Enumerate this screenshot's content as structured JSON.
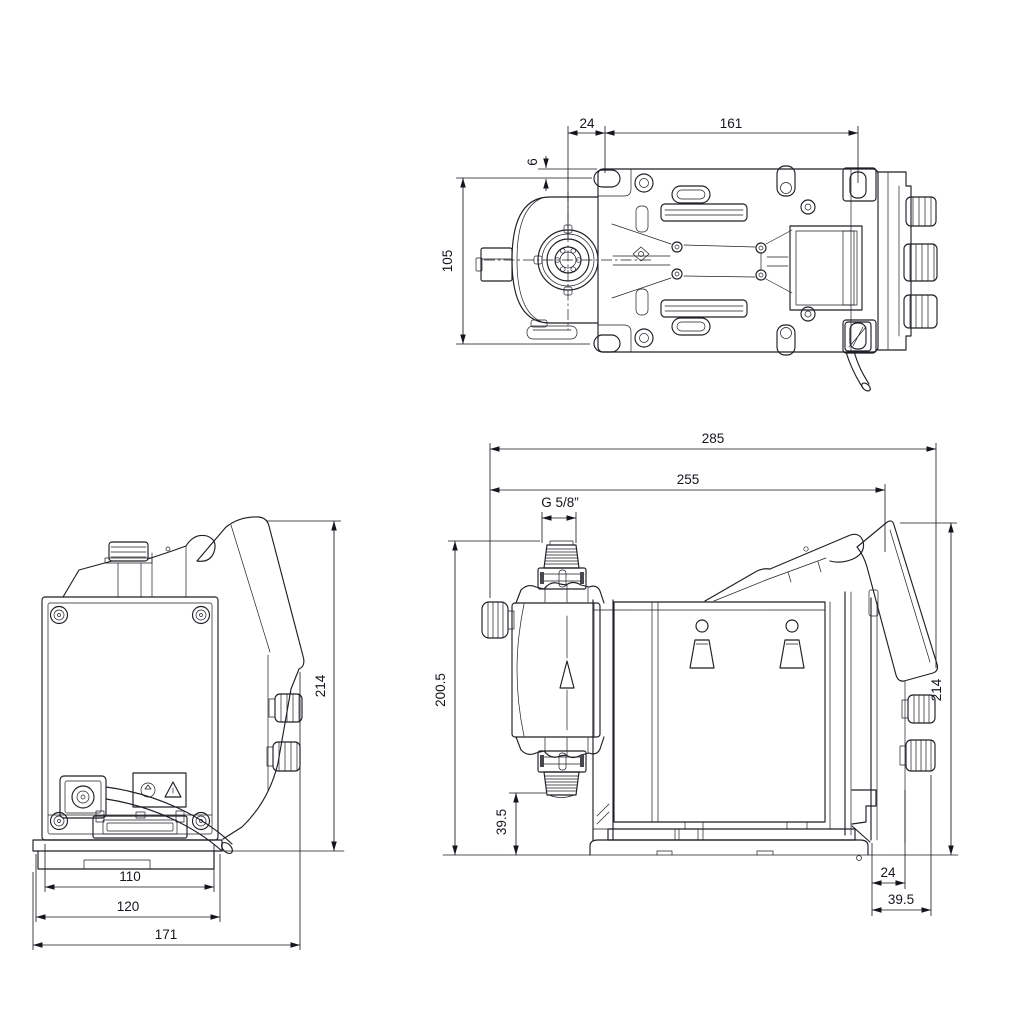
{
  "colors": {
    "background": "#ffffff",
    "line": "#1f1f26",
    "dim_text": "#15151d"
  },
  "views": {
    "top": {
      "title": "top-view",
      "dims": {
        "d24": "24",
        "d161": "161",
        "d6": "6",
        "d105": "105"
      }
    },
    "rear": {
      "title": "rear-view",
      "dims": {
        "d110": "110",
        "d120": "120",
        "d171": "171",
        "d214": "214"
      }
    },
    "side": {
      "title": "side-view",
      "dims": {
        "d285": "285",
        "d255": "255",
        "thread": "G 5/8”",
        "d200_5": "200.5",
        "d39_5_upper": "39.5",
        "d214": "214",
        "d24": "24",
        "d39_5_lower": "39.5"
      }
    }
  }
}
